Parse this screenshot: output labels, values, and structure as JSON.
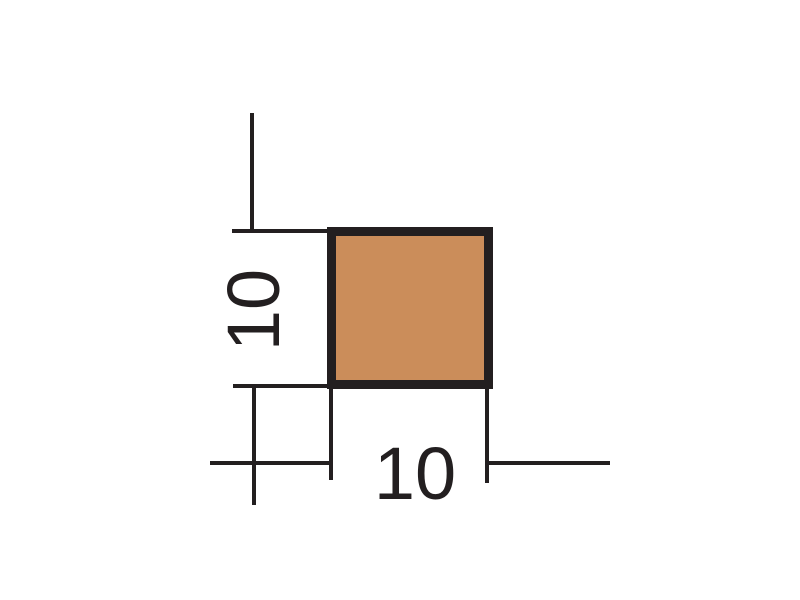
{
  "diagram": {
    "width_label": "10",
    "height_label": "10",
    "fill_color": "#CB8D5A",
    "line_color": "#231F20",
    "background_color": "#FFFFFF"
  }
}
